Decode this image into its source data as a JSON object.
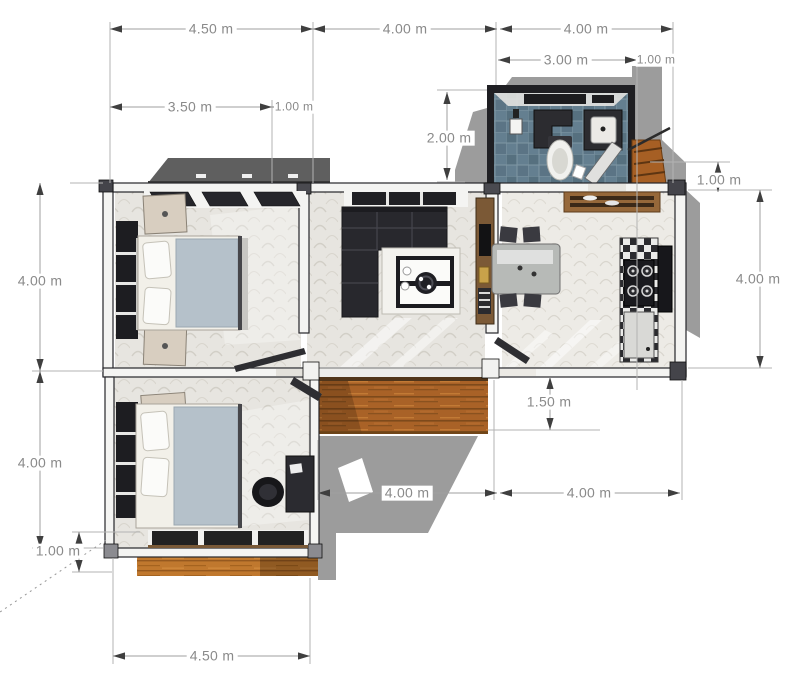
{
  "dimensions": {
    "top_left_width": "4.50 m",
    "top_middle_width": "4.00 m",
    "top_right_width": "4.00 m",
    "bathroom_width": "3.00 m",
    "bathroom_side_offset": "1.00 m",
    "bedroom1_window_span": "3.50 m",
    "bedroom1_wall_span": "1.00 m",
    "bathroom_depth": "2.00 m",
    "left_upper_height": "4.00 m",
    "left_lower_height": "4.00 m",
    "porch_depth": "1.00 m",
    "right_side_offset": "1.00 m",
    "right_side_height": "4.00 m",
    "deck_depth": "1.50 m",
    "bottom_left_width": "4.00 m",
    "bottom_right_width": "4.00 m",
    "bottom_total_width": "4.50 m"
  },
  "colors": {
    "dimension_text": "#8a8a8a",
    "dimension_line": "#9f9f9f",
    "arrow": "#3f3f3f",
    "wall_edge": "#26262a",
    "shadow": "#9c9c9c",
    "canopy": "#5f5f5f",
    "deck_wood": "#a96227",
    "porch_wood": "#c0782e",
    "bathroom_tile": "#637e8f",
    "sofa": "#28282d",
    "blanket": "#b5c1ca",
    "tv_console": "#7b5936",
    "nightstand": "#d8cec0"
  }
}
